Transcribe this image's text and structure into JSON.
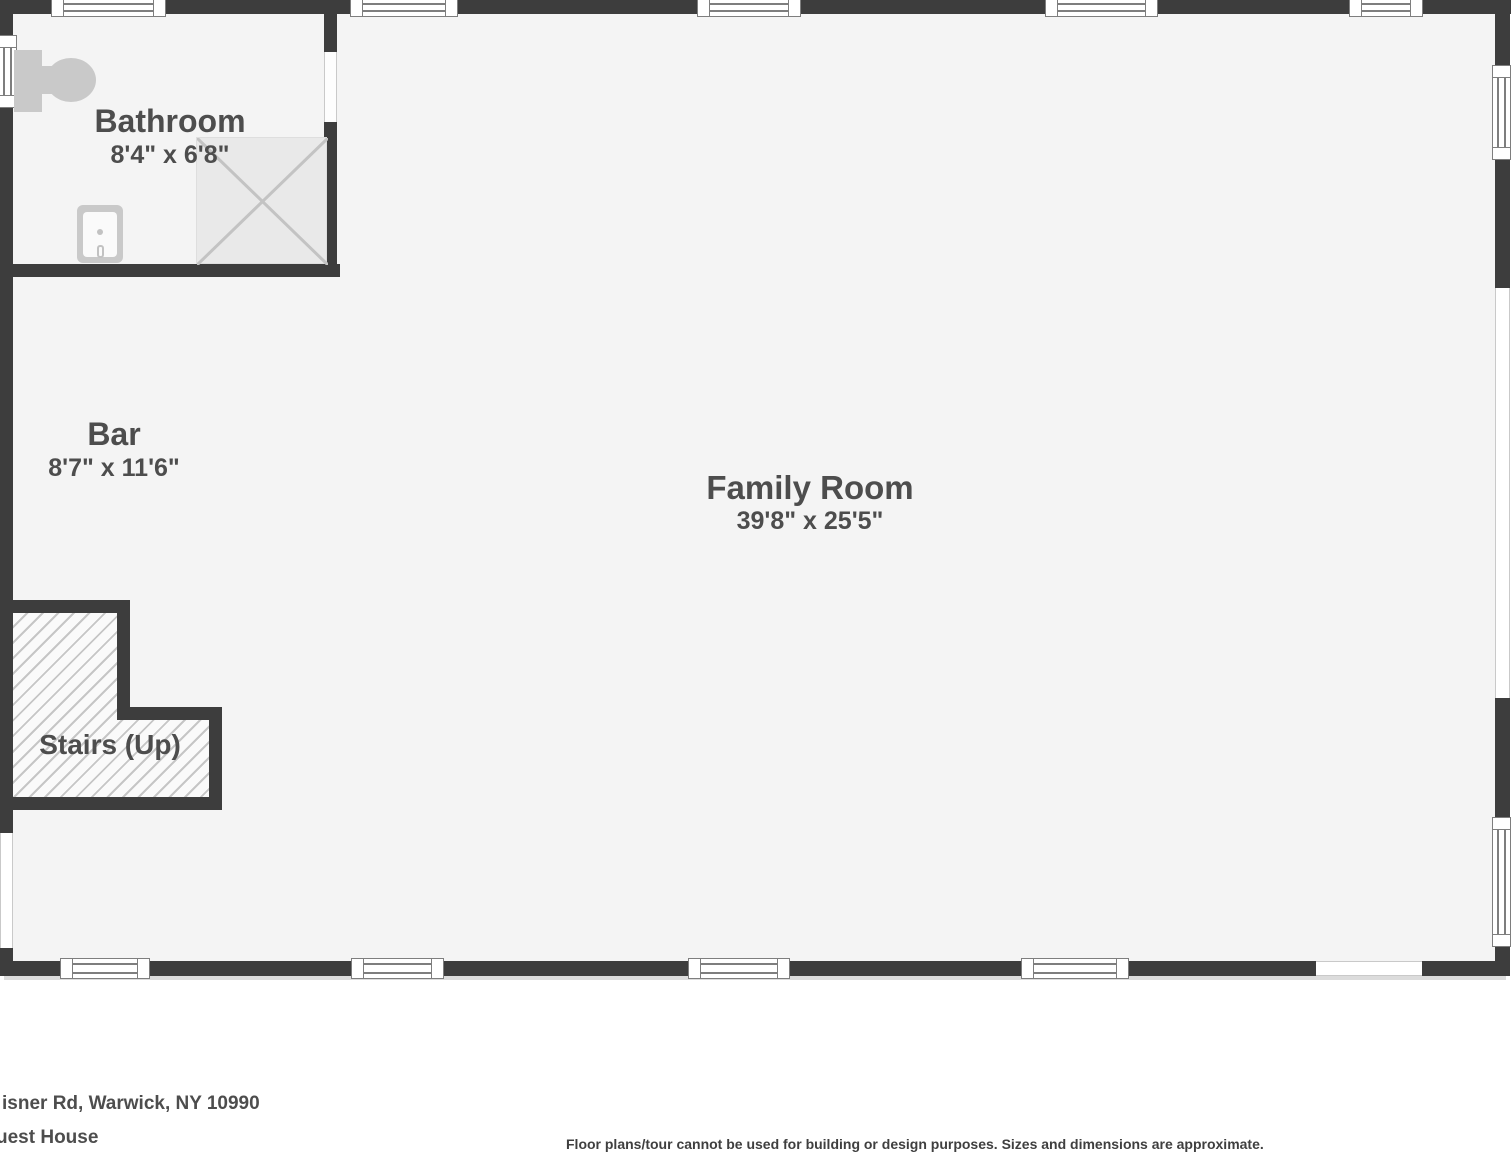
{
  "rooms": {
    "bathroom": {
      "name": "Bathroom",
      "dims": "8'4\" x 6'8\""
    },
    "bar": {
      "name": "Bar",
      "dims": "8'7\" x 11'6\""
    },
    "family_room": {
      "name": "Family Room",
      "dims": "39'8\" x 25'5\""
    },
    "stairs": {
      "name": "Stairs (Up)"
    }
  },
  "footer": {
    "address_partial": "isner Rd, Warwick, NY 10990",
    "building_partial": "uest House",
    "disclaimer": "Floor plans/tour cannot be used for building or design purposes. Sizes and dimensions are approximate."
  },
  "colors": {
    "wall": "#3d3d3d",
    "floor": "#f4f4f4",
    "fixture": "#c9c9c9",
    "hatch_line": "#c6c6c6",
    "label_text": "#4d4d4d"
  },
  "icons": {
    "toilet": "toilet-icon",
    "sink": "sink-icon",
    "shower": "shower-icon",
    "window": "window-symbol",
    "stairs_hatch": "stairs-hatch-pattern"
  }
}
